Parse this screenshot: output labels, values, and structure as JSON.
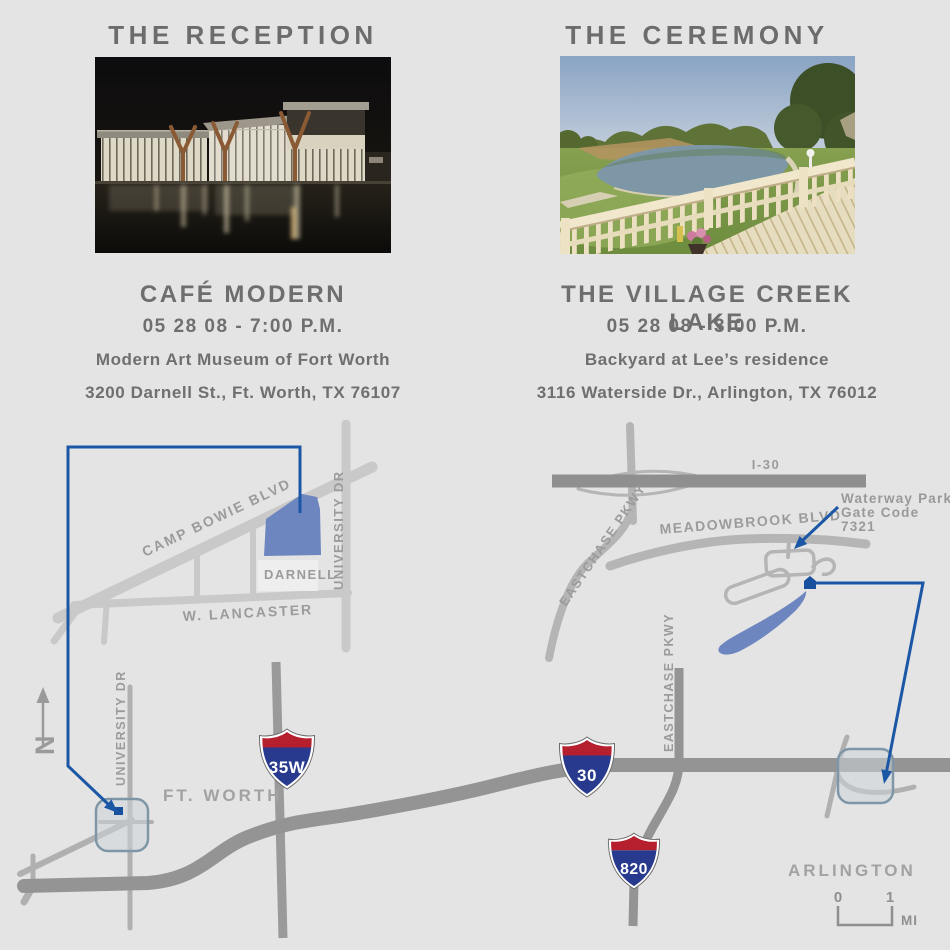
{
  "page": {
    "background": "#e4e4e4"
  },
  "reception": {
    "heading": "THE RECEPTION",
    "venue": "CAFÉ MODERN",
    "datetime": "05 28 08 - 7:00 P.M.",
    "venue_detail": "Modern Art Museum of Fort Worth",
    "address": "3200 Darnell St., Ft. Worth, TX 76107"
  },
  "ceremony": {
    "heading": "THE CEREMONY",
    "venue": "THE VILLAGE CREEK LAKE",
    "datetime": "05 28 08 - 3:00 P.M.",
    "venue_detail": "Backyard at Lee’s residence",
    "address": "3116 Waterside Dr., Arlington, TX 76012"
  },
  "reception_map": {
    "labels": {
      "camp_bowie": "CAMP BOWIE BLVD",
      "university_dr": "UNIVERSITY DR",
      "darnell": "DARNELL",
      "w_lancaster": "W. LANCASTER"
    }
  },
  "ceremony_map": {
    "labels": {
      "i30": "I-30",
      "eastchase_pkwy": "EASTCHASE PKWY",
      "meadowbrook_blvd": "MEADOWBROOK BLVD"
    },
    "callout": {
      "line1": "Waterway Park",
      "line2": "Gate Code",
      "line3": "7321"
    }
  },
  "overview_map": {
    "labels": {
      "ft_worth": "FT. WORTH",
      "arlington": "ARLINGTON",
      "university_dr": "UNIVERSITY DR",
      "eastchase_pkwy": "EASTCHASE PKWY",
      "north": "N"
    },
    "shields": {
      "i35w": "35W",
      "i30": "30",
      "i820": "820"
    },
    "scale": {
      "zero": "0",
      "one": "1",
      "unit": "MI"
    }
  },
  "colors": {
    "accent_blue": "#1c57a6",
    "site_blue": "#6e86bf",
    "shield_red": "#b51f2e",
    "shield_blue": "#283a8e",
    "road_gray": "#949494",
    "road_light": "#c9c9c9",
    "label_gray": "#9b9b9b",
    "text_gray": "#6e6e6e",
    "highlight_stroke": "#7e96a6"
  }
}
